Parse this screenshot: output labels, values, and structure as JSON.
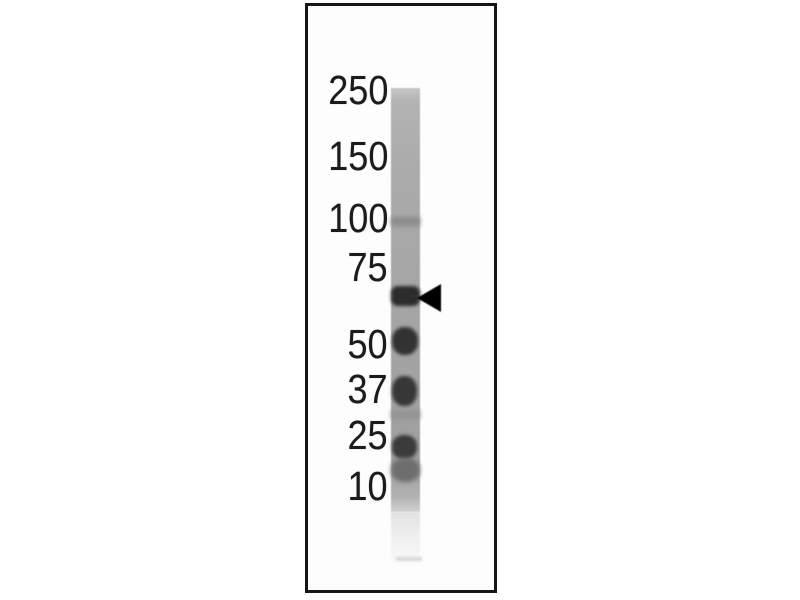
{
  "figure": {
    "kind": "western-blot-lane",
    "background_color": "#ffffff",
    "frame_border_color": "#161616"
  },
  "markers": {
    "labels": [
      "250",
      "150",
      "100",
      "75",
      "50",
      "37",
      "25",
      "10"
    ],
    "text_color": "#1b1b1b"
  },
  "lane": {
    "base_color": "#a6a6a6",
    "bands": [
      {
        "name": "band-near-100",
        "intensity": "faint",
        "color": "#8c8c8c"
      },
      {
        "name": "band-target-between-75-and-50",
        "intensity": "strong",
        "color": "#2c2c2c"
      },
      {
        "name": "band-near-50",
        "intensity": "strong",
        "color": "#323232"
      },
      {
        "name": "band-near-37",
        "intensity": "strong",
        "color": "#373737"
      },
      {
        "name": "band-near-30",
        "intensity": "faint",
        "color": "#949494"
      },
      {
        "name": "band-near-25",
        "intensity": "strong",
        "color": "#3b3b3b"
      },
      {
        "name": "band-near-20",
        "intensity": "medium",
        "color": "#6e6e6e"
      }
    ]
  },
  "arrow": {
    "symbol": "left-pointing-filled-triangle",
    "color": "#000000"
  }
}
